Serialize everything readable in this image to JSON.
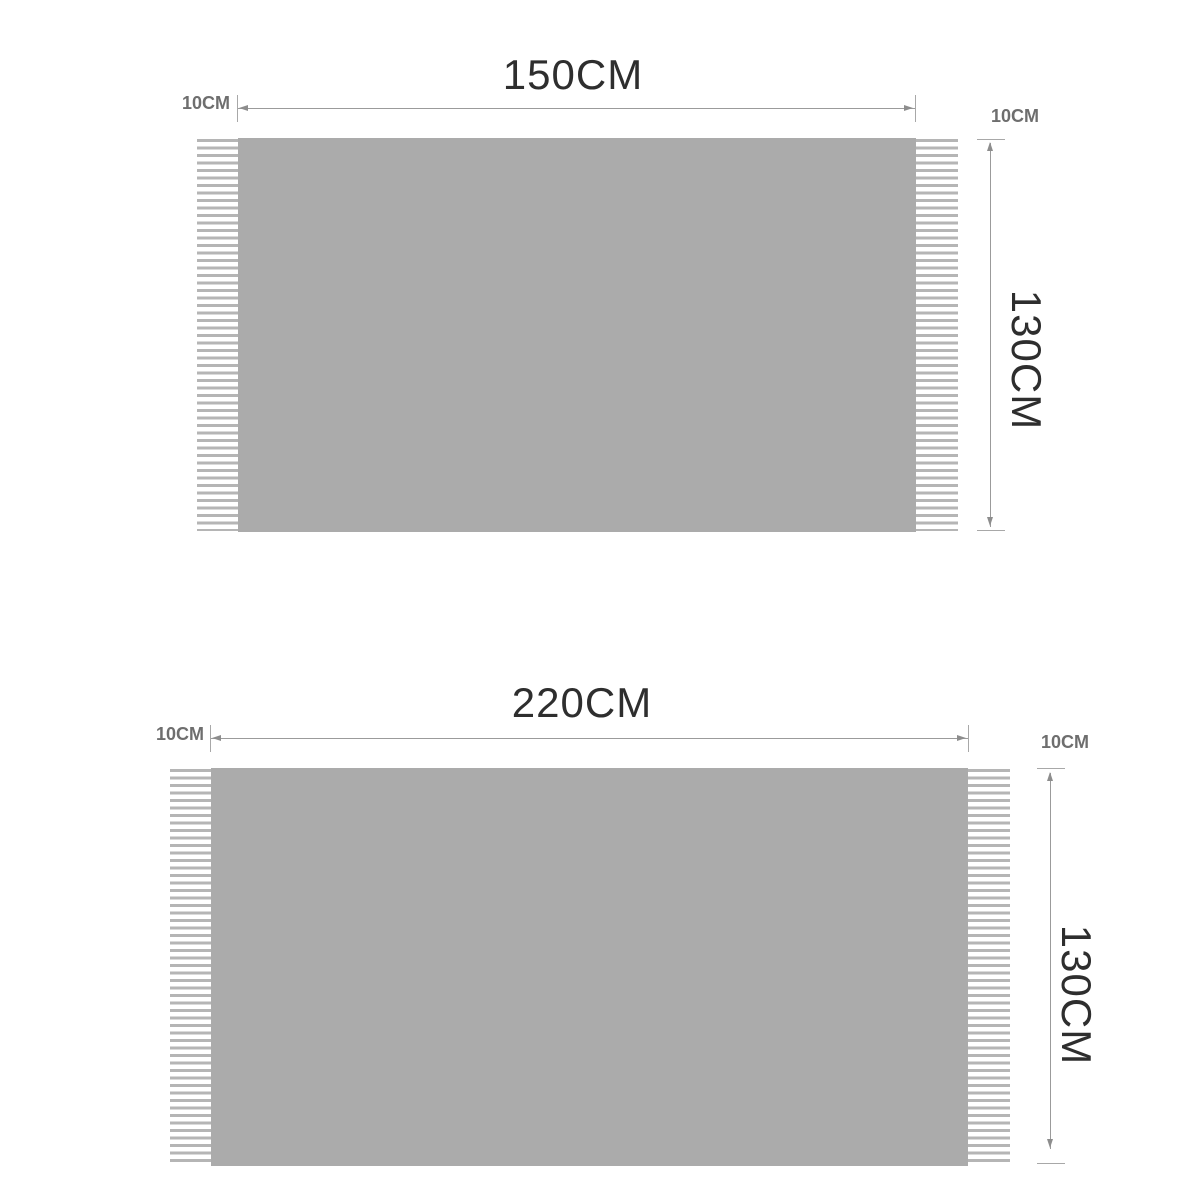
{
  "colors": {
    "background": "#ffffff",
    "blanket_fill": "#ababab",
    "fringe_stripe": "#b5b5b5",
    "dimension_line": "#9b9b9b",
    "title_text": "#2e2e2e",
    "small_label_text": "#6e6e6e"
  },
  "diagrams": [
    {
      "id": "blanket-150x130",
      "width_label": "150CM",
      "left_fringe_label": "10CM",
      "right_fringe_label": "10CM",
      "height_label": "130CM"
    },
    {
      "id": "blanket-220x130",
      "width_label": "220CM",
      "left_fringe_label": "10CM",
      "right_fringe_label": "10CM",
      "height_label": "130CM"
    }
  ]
}
